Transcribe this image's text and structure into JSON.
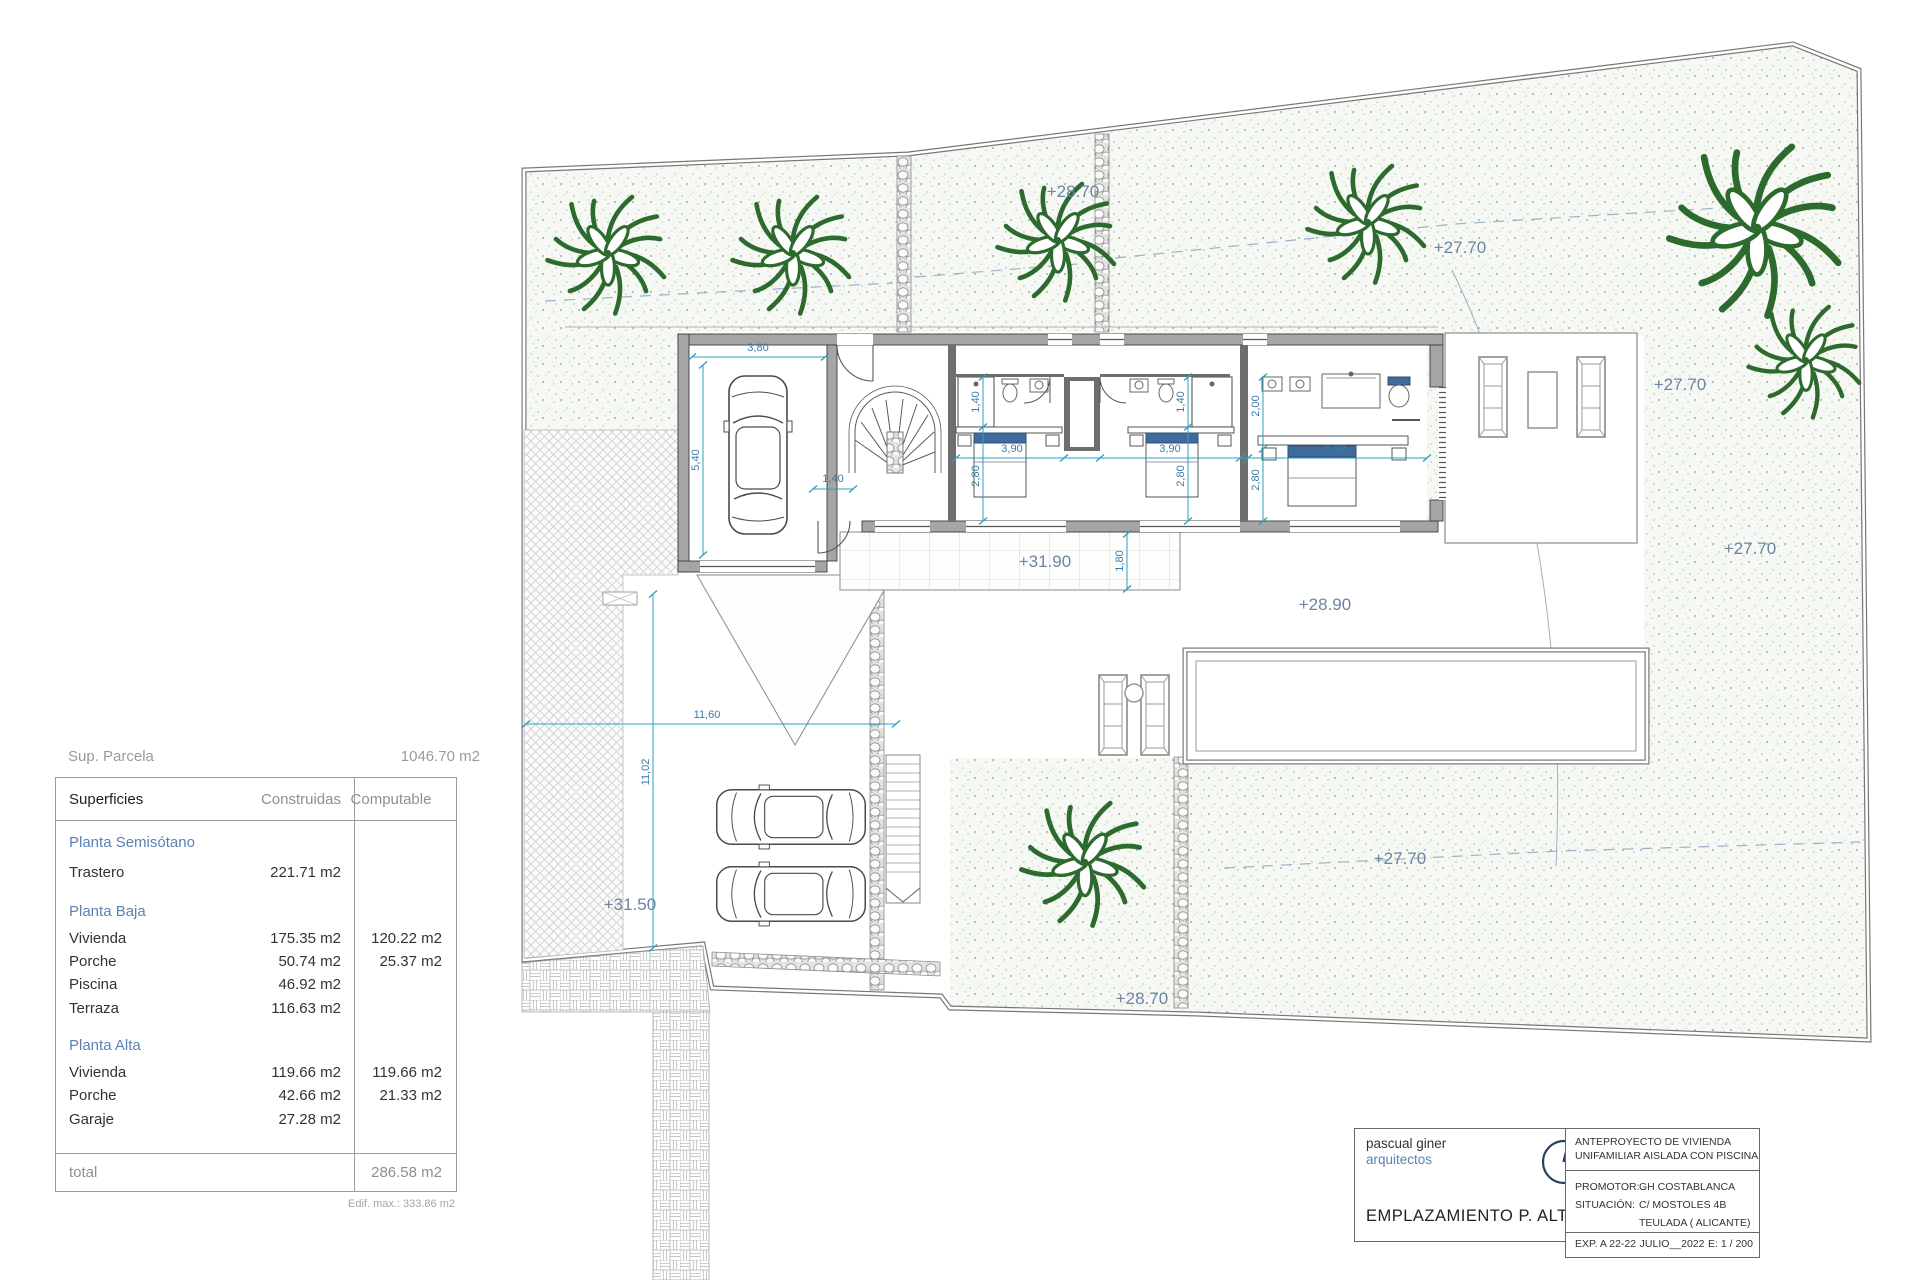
{
  "areas_table": {
    "parcel_label": "Sup. Parcela",
    "parcel_value": "1046.70 m2",
    "headers": {
      "col1": "Superficies",
      "col2": "Construidas",
      "col3": "Computable"
    },
    "sections": [
      {
        "title": "Planta Semisótano",
        "rows": [
          {
            "label": "Trastero",
            "built": "221.71 m2",
            "computable": ""
          }
        ]
      },
      {
        "title": "Planta Baja",
        "rows": [
          {
            "label": "Vivienda",
            "built": "175.35 m2",
            "computable": "120.22 m2"
          },
          {
            "label": "Porche",
            "built": "50.74 m2",
            "computable": "25.37 m2"
          },
          {
            "label": "Piscina",
            "built": "46.92 m2",
            "computable": ""
          },
          {
            "label": "Terraza",
            "built": "116.63 m2",
            "computable": ""
          }
        ]
      },
      {
        "title": "Planta Alta",
        "rows": [
          {
            "label": "Vivienda",
            "built": "119.66 m2",
            "computable": "119.66 m2"
          },
          {
            "label": "Porche",
            "built": "42.66 m2",
            "computable": "21.33 m2"
          },
          {
            "label": "Garaje",
            "built": "27.28 m2",
            "computable": ""
          }
        ]
      }
    ],
    "total_label": "total",
    "total_value": "286.58 m2",
    "footnote": "Edif. max.: 333.86 m2"
  },
  "title_block": {
    "firm_name": "pascual giner",
    "firm_sub": "arquitectos",
    "sheet_name": "EMPLAZAMIENTO P. ALTA",
    "project_line1": "ANTEPROYECTO  DE VIVIENDA",
    "project_line2": "UNIFAMILIAR AISLADA CON PISCINA",
    "promotor_label": "PROMOTOR:",
    "promotor_value": "GH COSTABLANCA",
    "situacion_label": "SITUACIÓN:",
    "situacion_value": "C/ MOSTOLES 4B",
    "situacion_value2": "TEULADA  ( ALICANTE)",
    "exp": "EXP. A 22-22",
    "date": "JULIO__2022",
    "scale": "E: 1 / 200"
  },
  "plan": {
    "levels": {
      "top": "+28.70",
      "topRight": "+27.70",
      "rightUpper": "+27.70",
      "rightMid": "+27.70",
      "terrace": "+31.90",
      "poolTerrace": "+28.90",
      "driveway": "+31.50",
      "gardenBottomRight": "+27.70",
      "gardenBottom": "+28.70"
    },
    "dims": {
      "garageWidth": "3,80",
      "garageDepth": "5,40",
      "hallWidth": "1,40",
      "bed1Bath": "1,40",
      "bed1Width": "3,90",
      "bed1Depth": "2,80",
      "bed2Bath": "1,40",
      "bed2Width": "3,90",
      "bed2Depth": "2,80",
      "masterBath": "2,00",
      "masterWidth": "6,30",
      "masterDepth": "2,80",
      "terraceDepth": "1,80",
      "plotDriveWidth": "11,60",
      "plotDriveDepth": "11,02"
    },
    "colors": {
      "tree_green": "#2d6a2d",
      "level_blue": "#6d84a5",
      "dim_cyan": "#2d9fc4",
      "pillow_blue": "#3f6b9c"
    }
  }
}
